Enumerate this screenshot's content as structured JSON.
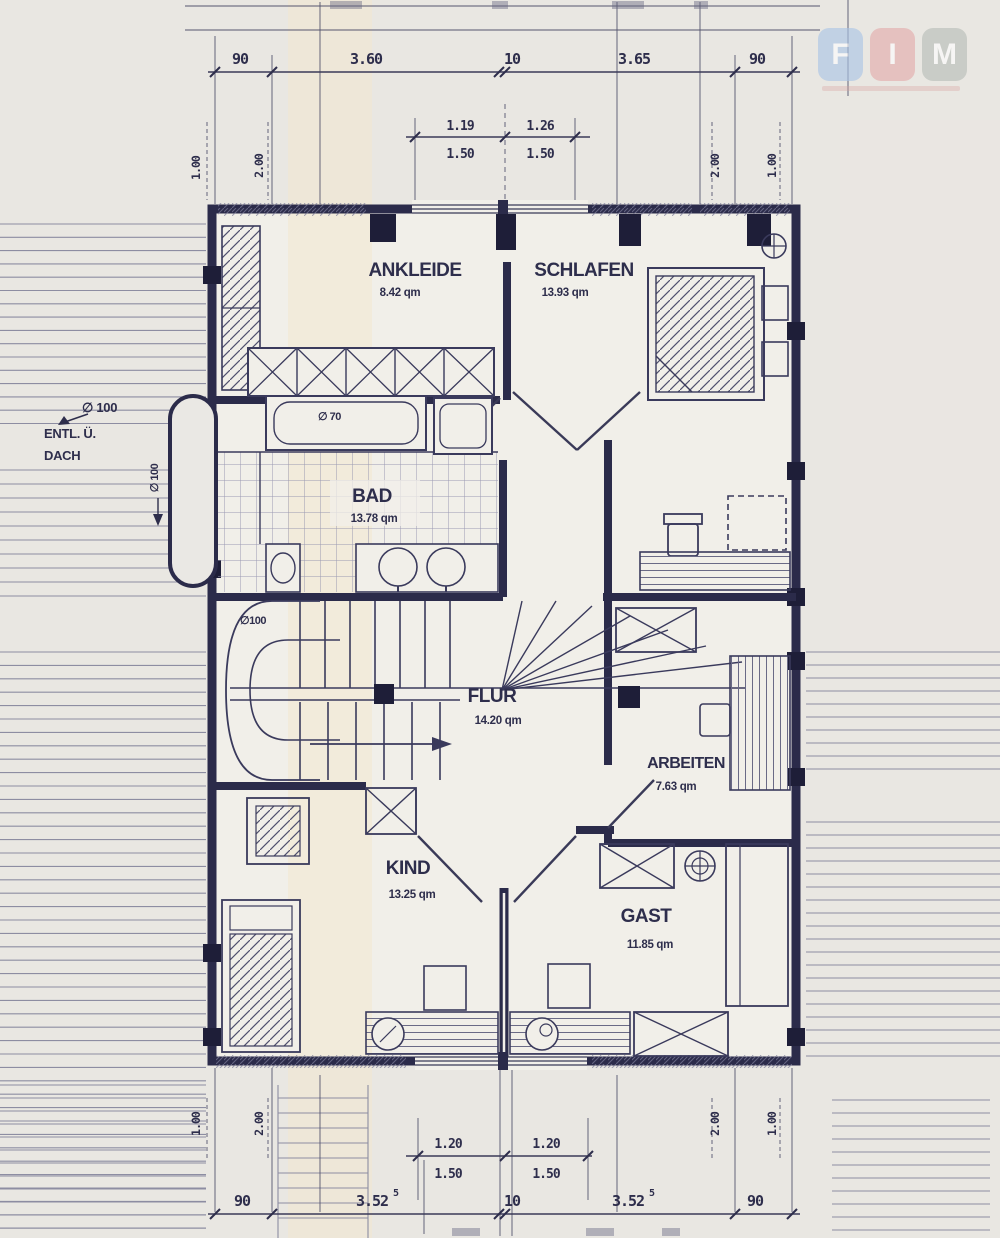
{
  "logo": {
    "letters": [
      "F",
      "I",
      "M"
    ],
    "colors": [
      "#a9c5e6",
      "#e3abab",
      "#b7bdb7"
    ]
  },
  "rooms": {
    "ankleide": {
      "name": "ANKLEIDE",
      "area": "8.42 qm"
    },
    "schlafen": {
      "name": "SCHLAFEN",
      "area": "13.93 qm"
    },
    "bad": {
      "name": "BAD",
      "area": "13.78 qm"
    },
    "flur": {
      "name": "FLUR",
      "area": "14.20 qm"
    },
    "arbeiten": {
      "name": "ARBEITEN",
      "area": "7.63 qm"
    },
    "kind": {
      "name": "KIND",
      "area": "13.25 qm"
    },
    "gast": {
      "name": "GAST",
      "area": "11.85 qm"
    }
  },
  "annotations": {
    "vent_line1": "ENTL. Ü.",
    "vent_line2": "DACH",
    "vent_dia": "∅ 100",
    "vent_dia_side": "∅ 100",
    "stair_dia": "∅100",
    "tub_dia": "∅ 70"
  },
  "dimensions": {
    "top": {
      "segments": [
        "90",
        "3.60",
        "10",
        "3.65",
        "90"
      ]
    },
    "top_windows": {
      "w1": "1.19",
      "h1": "1.50",
      "w2": "1.26",
      "h2": "1.50"
    },
    "top_vertical": {
      "left_outer": "1.00",
      "left_inner": "2.00",
      "right_inner": "2.00",
      "right_outer": "1.00"
    },
    "bottom": {
      "segments": [
        "90",
        "3.52",
        "10",
        "3.52",
        "90"
      ],
      "sup": "5"
    },
    "bottom_windows": {
      "w1": "1.20",
      "h1": "1.50",
      "w2": "1.20",
      "h2": "1.50"
    },
    "bottom_vertical": {
      "left_outer": "1.00",
      "left_inner": "2.00",
      "right_inner": "2.00",
      "right_outer": "1.00"
    }
  }
}
